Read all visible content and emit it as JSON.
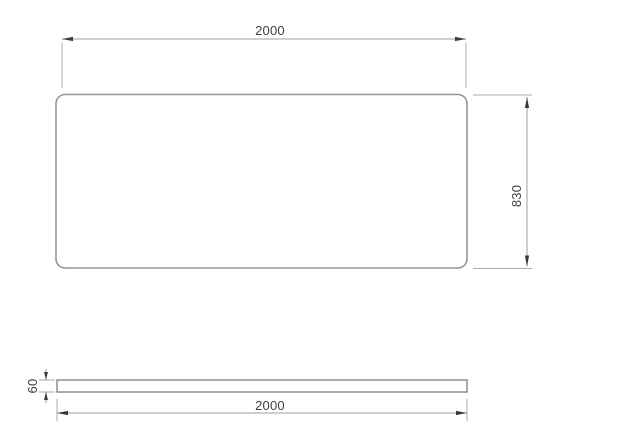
{
  "drawing": {
    "kind": "technical-drawing",
    "views": {
      "top_view": {
        "width_label": "2000",
        "height_label": "830"
      },
      "side_view": {
        "thickness_label": "60",
        "length_label": "2000"
      }
    },
    "colors": {
      "background": "#ffffff",
      "plate_outline": "#969696",
      "dimension_line": "#9e9e9e",
      "extension_line": "#ababab",
      "arrowhead": "#383838",
      "label_text": "#3f3f3f"
    }
  }
}
